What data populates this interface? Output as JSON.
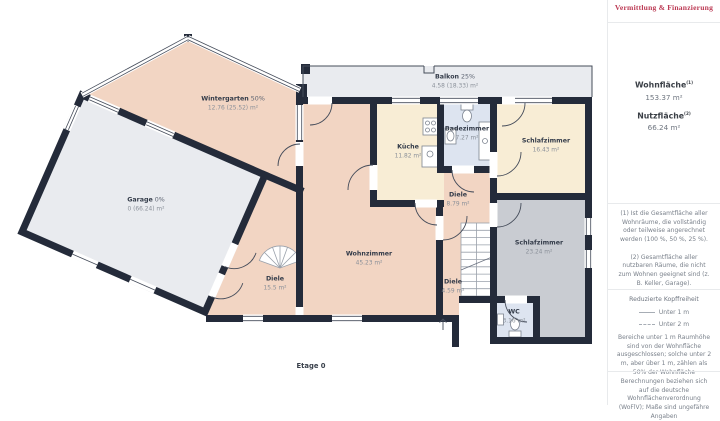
{
  "colors": {
    "wall": "#242b3a",
    "line": "#454c5a",
    "thin": "#9aa1ab",
    "peach": "#f2d5c3",
    "cream": "#f8edd5",
    "blue": "#dde4f0",
    "gray_room": "#c9ccd2",
    "light_gray": "#e9ebef",
    "accent_red": "#bc3a54"
  },
  "plan": {
    "floor_label": "Etage 0",
    "rooms": [
      {
        "name": "Balkon",
        "percent": "25%",
        "area": "4.58 (18.33) m²"
      },
      {
        "name": "Wintergarten",
        "percent": "50%",
        "area": "12.76 (25.52) m²"
      },
      {
        "name": "Garage",
        "percent": "0%",
        "area": "0 (66.24) m²"
      },
      {
        "name": "Küche",
        "percent": "",
        "area": "11.82 m²"
      },
      {
        "name": "Badezimmer",
        "percent": "",
        "area": "7.27 m²"
      },
      {
        "name": "Schlafzimmer",
        "percent": "",
        "area": "16.43 m²"
      },
      {
        "name": "Diele",
        "percent": "",
        "area": "8.79 m²"
      },
      {
        "name": "Schlafzimmer",
        "percent": "",
        "area": "23.24 m²"
      },
      {
        "name": "Wohnzimmer",
        "percent": "",
        "area": "45.23 m²"
      },
      {
        "name": "Diele",
        "percent": "",
        "area": "15.5 m²"
      },
      {
        "name": "Diele",
        "percent": "",
        "area": "4.59 m²"
      },
      {
        "name": "WC",
        "percent": "",
        "area": "3.16 m²"
      }
    ]
  },
  "sidebar": {
    "logo_tagline": "Vermittlung & Finanzierung",
    "stats": [
      {
        "label": "Wohnfläche",
        "sup": "(1)",
        "value": "153.37 m²"
      },
      {
        "label": "Nutzfläche",
        "sup": "(2)",
        "value": "66.24 m²"
      }
    ],
    "footnotes": [
      "(1) Ist die Gesamtfläche aller Wohnräume, die vollständig oder teilweise angerechnet werden (100 %, 50 %, 25 %).",
      "(2) Gesamtfläche aller nutzbaren Räume, die nicht zum Wohnen geeignet sind (z. B. Keller, Garage)."
    ],
    "legend": {
      "title": "Reduzierte Kopffreiheit",
      "items": [
        {
          "style": "solid",
          "label": "Unter 1 m"
        },
        {
          "style": "dashed",
          "label": "Unter 2 m"
        }
      ],
      "note": "Bereiche unter 1 m Raumhöhe sind von der Wohnfläche ausgeschlossen; solche unter 2 m, aber über 1 m, zählen als 50% der Wohnfläche"
    },
    "disclaimer": "Berechnungen beziehen sich auf die deutsche Wohnflächenverordnung (WoFlV); Maße sind ungefähre Angaben"
  }
}
